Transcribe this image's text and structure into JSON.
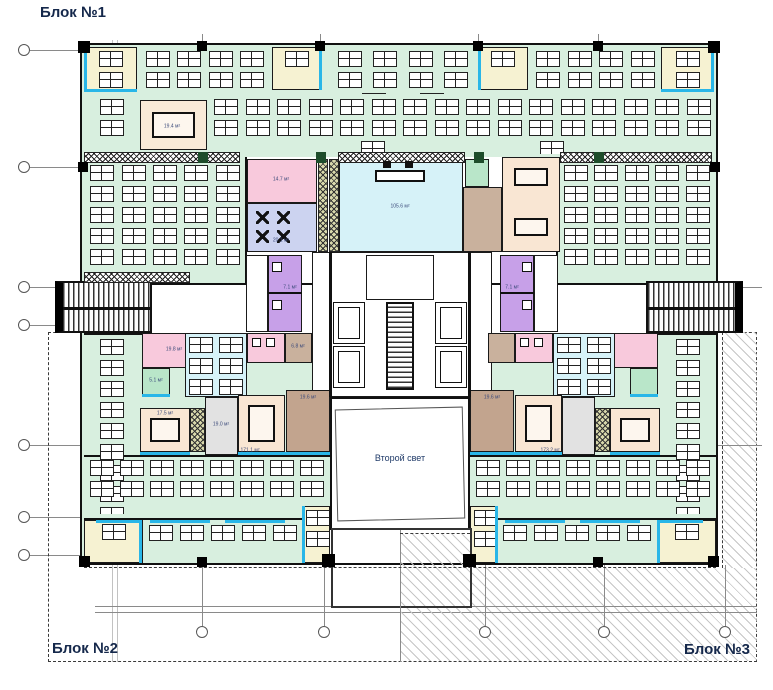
{
  "blocks": {
    "b1": "Блок №1",
    "b2": "Блок №2",
    "b3": "Блок №3"
  },
  "void": {
    "label": "Второй свет"
  },
  "areas": {
    "meeting_top_left": "19.4 м²",
    "pink_upper": "14.7 м²",
    "cafe": "20.1 м²",
    "reception": "105.6 м²",
    "pink_lower_left": "19.8 м²",
    "meeting_lower_left": "17.5 м²",
    "corridor_lower_left": "19.0 м²",
    "tan_void_left": "19.6 м²",
    "tan_void_right": "19.6 м²",
    "office_lower_left": "171.1 м²",
    "office_lower_right": "173.2 м²",
    "wc_left": "7.1 м²",
    "wc_right": "7.1 м²",
    "tan_core_left": "6.8 м²",
    "green_small_left": "5.1 м²"
  },
  "palette": {
    "mint_office": "#d8efdf",
    "pink_room": "#f8c9dc",
    "lavender_cafe": "#ccd3f0",
    "purple_wc": "#c7a0e8",
    "tan_room": "#c9b19d",
    "dark_tan_room": "#c2a48e",
    "peach_meeting": "#f9e6d3",
    "yellow_office": "#f6f2d2",
    "cyan_hall": "#d6f2f8",
    "accent_cyan": "#29b6e8",
    "olive_strip": "#d8d8ab",
    "gray_corridor": "#e2e2e2",
    "green_room": "#b9e6c9",
    "wall": "#111111",
    "label_text": "#1f3a68"
  }
}
